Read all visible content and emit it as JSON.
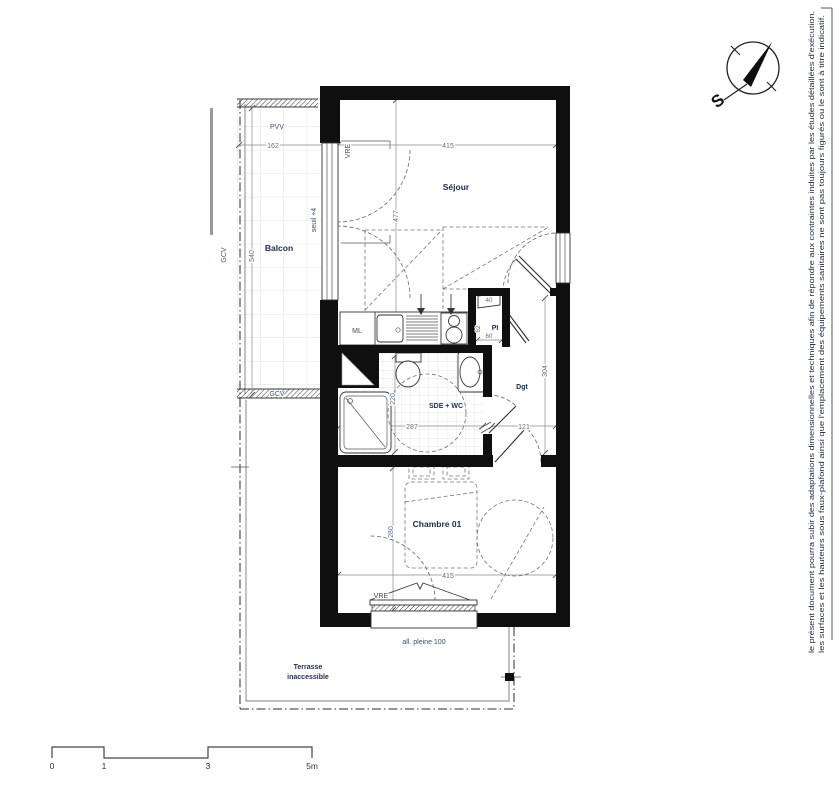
{
  "labels": {
    "balcon": "Balcon",
    "sejour": "Séjour",
    "chambre": "Chambre 01",
    "sde": "SDE + WC",
    "dgt": "Dgt",
    "pi": "PI",
    "ml": "ML",
    "terrasse1": "Terrasse",
    "terrasse2": "inaccessible",
    "allege": "all. pleine 100",
    "seuil": "seuil +4"
  },
  "codes": {
    "pvv": "PVV",
    "vre_sejour": "VRE",
    "vre_chambre": "VRE",
    "gcv_left": "GCV",
    "gcv_bottom": "GCV"
  },
  "dims": {
    "d162": "162",
    "d540": "540",
    "d415_top": "415",
    "d477": "477",
    "d40": "40",
    "d62": "62",
    "d60": "60",
    "d304": "304",
    "d287": "287",
    "d220": "220",
    "d121": "121",
    "d280": "280",
    "d415_bottom": "415"
  },
  "compass": {
    "south": "S"
  },
  "scale": {
    "m0": "0",
    "m1": "1",
    "m3": "3",
    "m5": "5m"
  },
  "disclaimer": {
    "line1": "le présent document pourra subir des adaptations dimensionnelles et techniques afin de répondre aux contraintes induites par les études détaillées d'exécution.",
    "line2": "les surfaces et les hauteurs sous faux-plafond ainsi que l'emplacement des équipements sanitaires ne sont pas toujours figurés ou le sont à titre indicatif."
  },
  "colors": {
    "wall": "#0f0f0f",
    "room_label": "#1f2a4d",
    "dimension": "#5d6e84",
    "background": "#ffffff"
  }
}
